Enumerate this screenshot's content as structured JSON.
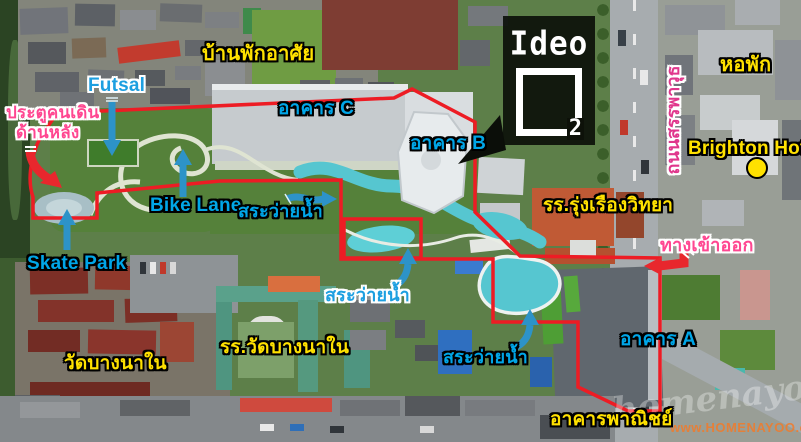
{
  "labels": {
    "residential_area": "บ้านพักอาศัย",
    "futsal": "Futsal",
    "back_gate_line1": "ประตูคนเดิน",
    "back_gate_line2": "ด้านหลัง",
    "building_c": "อาคาร C",
    "building_b": "อาคาร B",
    "building_a": "อาคาร A",
    "bike_lane": "Bike Lane",
    "swimming_pool_1": "สระว่ายน้ำ",
    "swimming_pool_2": "สระว่ายน้ำ",
    "swimming_pool_3": "สระว่ายน้ำ",
    "skate_park": "Skate Park",
    "wat_bang_na_nai": "วัดบางนาใน",
    "wat_bang_na_nai_school": "รร.วัดบางนาใน",
    "rungrueang_school": "รร.รุ่งเรืองวิทยา",
    "commercial_buildings": "อาคารพาณิชย์",
    "entrance_exit": "ทางเข้าออก",
    "dormitory": "หอพัก",
    "brighton_hotel": "Brighton Hotel",
    "sanphawut_road": "ถนนสรรพาวุธ"
  },
  "logo": {
    "brand_text": "Ideo",
    "sub_text": "2"
  },
  "watermark": {
    "script_text": "homenayoo",
    "url_text": "www.HOMENAYOO.com"
  },
  "markers": {
    "brighton_hotel_marker": "yellow-dot"
  },
  "colors": {
    "boundary_red": "#ed1c24",
    "arrow_blue": "#2d93c8",
    "arrow_red": "#e8272d",
    "label_yellow": "#ffe100",
    "label_blue": "#00a6e8",
    "label_pink": "#ff4791",
    "road_label_magenta": "#e0368c",
    "pool_turquoise": "#56c6d0",
    "marker_yellow": "#ffe100"
  }
}
